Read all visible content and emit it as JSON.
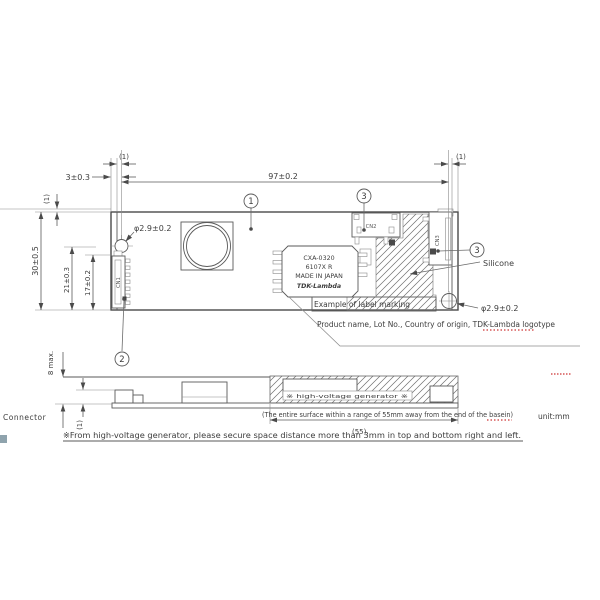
{
  "top_view": {
    "dims": {
      "width": "97±0.2",
      "left_offset": "3±0.3",
      "tiny_left": "(1)",
      "tiny_right": "(1)",
      "tiny_edge": "(1)",
      "height": "30±0.5",
      "d21": "21±0.3",
      "d17": "17±0.2",
      "hole_left": "φ2.9±0.2",
      "hole_right": "φ2.9±0.2"
    },
    "balloons": {
      "b1": "1",
      "b2": "2",
      "b3a": "3",
      "b3b": "3"
    },
    "connectors": {
      "cn1": "CN1",
      "cn2": "CN2",
      "cn3": "CN3"
    },
    "chip_label": {
      "model": "CXA-0320",
      "lot": "6107X R",
      "origin": "MADE IN JAPAN",
      "logo": "TDK-Lambda"
    },
    "annotations": {
      "silicone": "Silicone",
      "example": "Example of label marking",
      "description": "Product name, Lot No., Country of origin, TDK-Lambda logotype"
    }
  },
  "side_view": {
    "dims": {
      "height_max": "8 max.",
      "tiny": "(1)",
      "range": "(55)"
    },
    "labels": {
      "connector": "Connector",
      "hv_zone": "※ high-voltage generator ※"
    }
  },
  "footer": {
    "unit": "unit:mm",
    "note_range": "(The entire surface within a range of 55mm away from the end of the basein)",
    "note_clearance": "※From high-voltage generator, please secure space distance more than 3mm in top and bottom right and left."
  }
}
